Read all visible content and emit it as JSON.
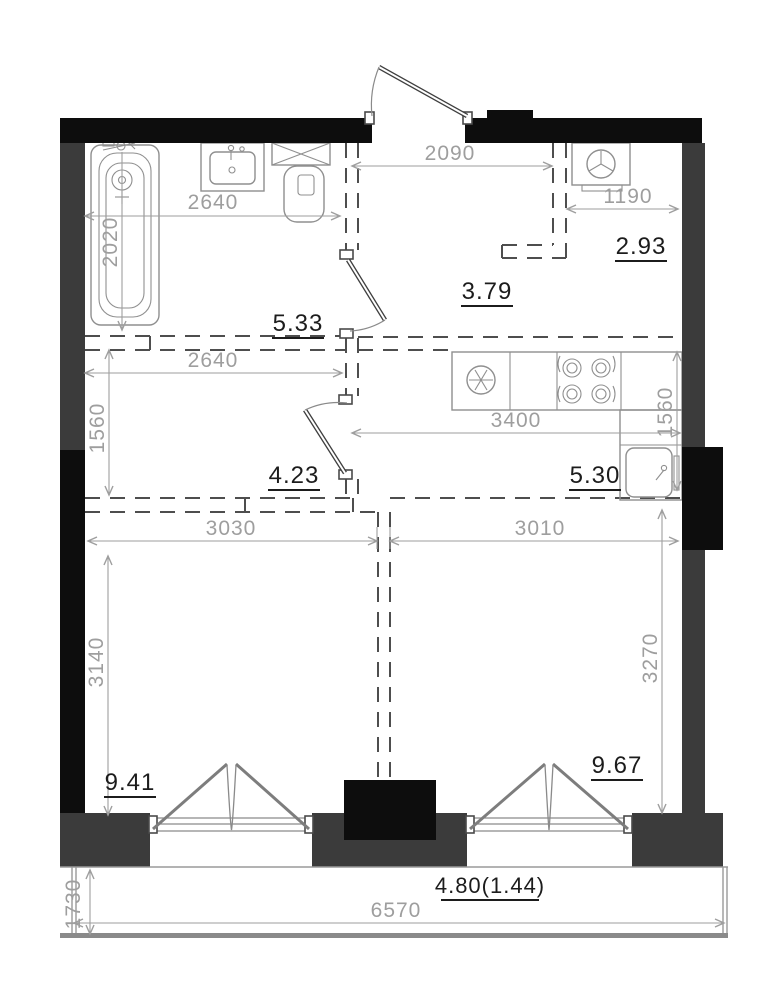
{
  "plan": {
    "rooms": {
      "bathroom": "5.33",
      "hallway": "3.79",
      "wardrobe": "2.93",
      "corridor": "4.23",
      "kitchen": "5.30",
      "room_left": "9.41",
      "room_right": "9.67",
      "balcony": "4.80(1.44)"
    },
    "dimensions": {
      "bath_width": "2640",
      "entry_width": "2090",
      "wardrobe_width": "1190",
      "bath_depth": "2020",
      "corridor_width": "2640",
      "corridor_depth": "1560",
      "kitchen_width": "3400",
      "kitchen_depth": "1560",
      "room_left_width": "3030",
      "room_right_width": "3010",
      "room_left_depth": "3140",
      "room_right_depth": "3270",
      "balcony_width": "6570",
      "balcony_depth": "1730"
    }
  }
}
